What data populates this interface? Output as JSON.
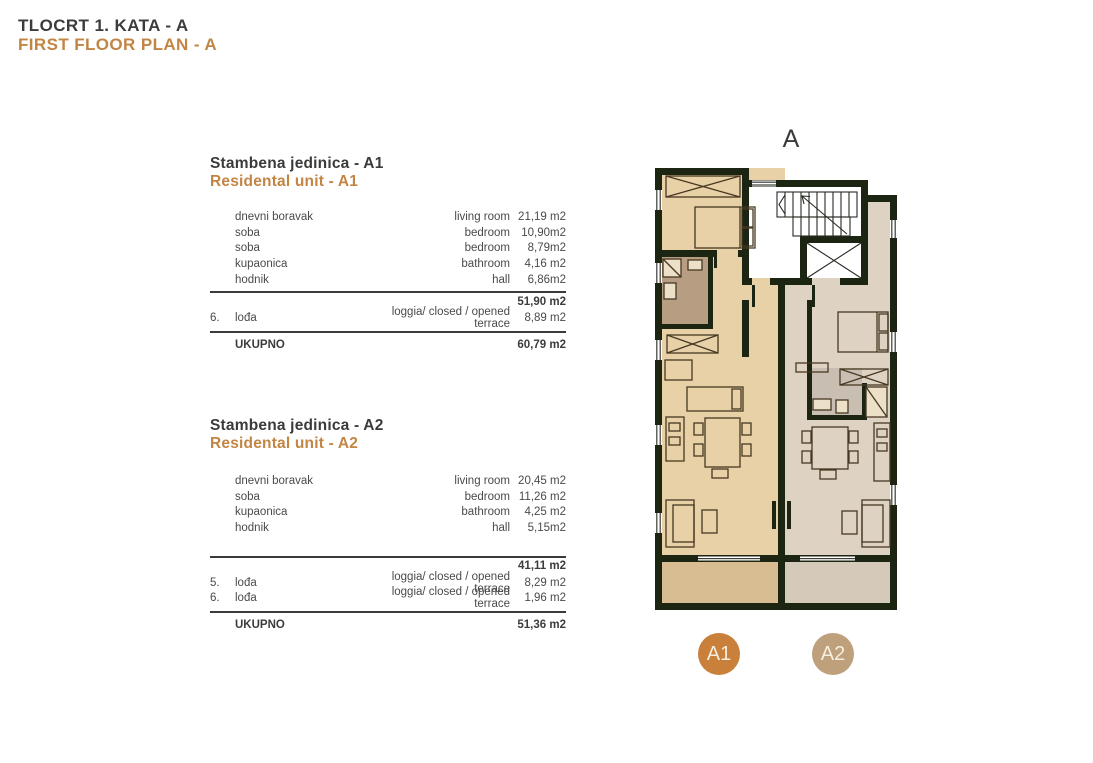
{
  "document": {
    "title_hr": "TLOCRT 1. KATA - A",
    "title_en": "FIRST FLOOR PLAN - A"
  },
  "units": [
    {
      "id": "A1",
      "title_hr": "Stambena jedinica - A1",
      "title_en": "Residental unit - A1",
      "rows": [
        {
          "num": "",
          "hr": "dnevni boravak",
          "en": "living room",
          "area": "21,19 m2"
        },
        {
          "num": "",
          "hr": "soba",
          "en": "bedroom",
          "area": "10,90m2"
        },
        {
          "num": "",
          "hr": "soba",
          "en": "bedroom",
          "area": "8,79m2"
        },
        {
          "num": "",
          "hr": "kupaonica",
          "en": "bathroom",
          "area": "4,16 m2"
        },
        {
          "num": "",
          "hr": "hodnik",
          "en": "hall",
          "area": "6,86m2"
        }
      ],
      "subtotal": "51,90 m2",
      "extras": [
        {
          "num": "6.",
          "hr": "lođa",
          "en": "loggia/ closed / opened terrace",
          "area": "8,89 m2"
        }
      ],
      "total_label": "UKUPNO",
      "total": "60,79 m2"
    },
    {
      "id": "A2",
      "title_hr": "Stambena jedinica - A2",
      "title_en": "Residental unit - A2",
      "rows": [
        {
          "num": "",
          "hr": "dnevni boravak",
          "en": "living room",
          "area": "20,45 m2"
        },
        {
          "num": "",
          "hr": "soba",
          "en": "bedroom",
          "area": "11,26 m2"
        },
        {
          "num": "",
          "hr": "kupaonica",
          "en": "bathroom",
          "area": "4,25 m2"
        },
        {
          "num": "",
          "hr": "hodnik",
          "en": "hall",
          "area": "5,15m2"
        }
      ],
      "subtotal": "41,11 m2",
      "extras": [
        {
          "num": "5.",
          "hr": "lođa",
          "en": "loggia/ closed / opened terrace",
          "area": "8,29 m2"
        },
        {
          "num": "6.",
          "hr": "lođa",
          "en": "loggia/ closed / opened terrace",
          "area": "1,96 m2"
        }
      ],
      "total_label": "UKUPNO",
      "total": "51,36 m2"
    }
  ],
  "plan": {
    "building_label": "A",
    "badge_a1": "A1",
    "badge_a2": "A2",
    "colors": {
      "wall": "#1c2412",
      "unit_a1_fill": "#e8d1a7",
      "unit_a2_fill": "#ded2c3",
      "loggia_a1_fill": "#d8bc92",
      "loggia_a2_fill": "#d5c9ba",
      "bath_a1_fill": "#b79e82",
      "bath_a2_fill": "#c8bfb2",
      "badge_a1_color": "#c8803b",
      "badge_a2_color": "#bfa07c",
      "accent_orange": "#c28544"
    }
  }
}
